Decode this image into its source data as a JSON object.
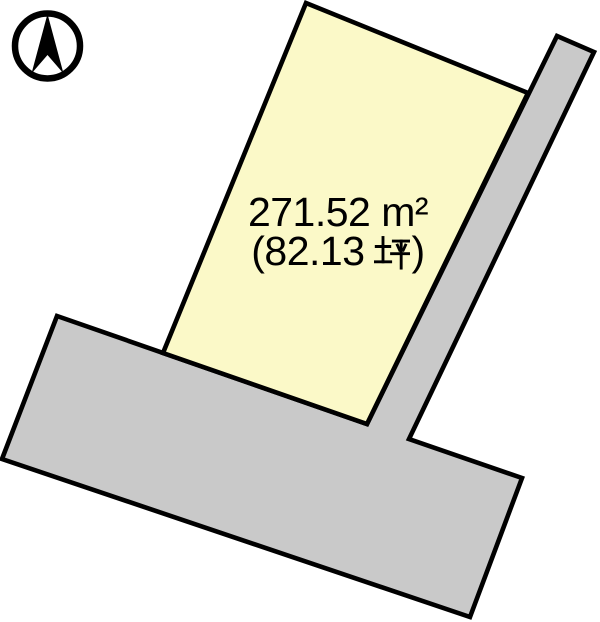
{
  "canvas": {
    "background": "#ffffff"
  },
  "colors": {
    "parcel_fill": "#fbf9c8",
    "road_fill": "#c9c9c9",
    "outline": "#000000",
    "text": "#000000"
  },
  "compass": {
    "icon": "north-arrow",
    "color": "#000000"
  },
  "parcel": {
    "area_m2_label": "271.52 m²",
    "area_tsubo_label": "(82.13 坪)",
    "area_tsubo_prefix": "(82.13",
    "area_tsubo_unit": "坪",
    "area_tsubo_suffix": ")"
  }
}
